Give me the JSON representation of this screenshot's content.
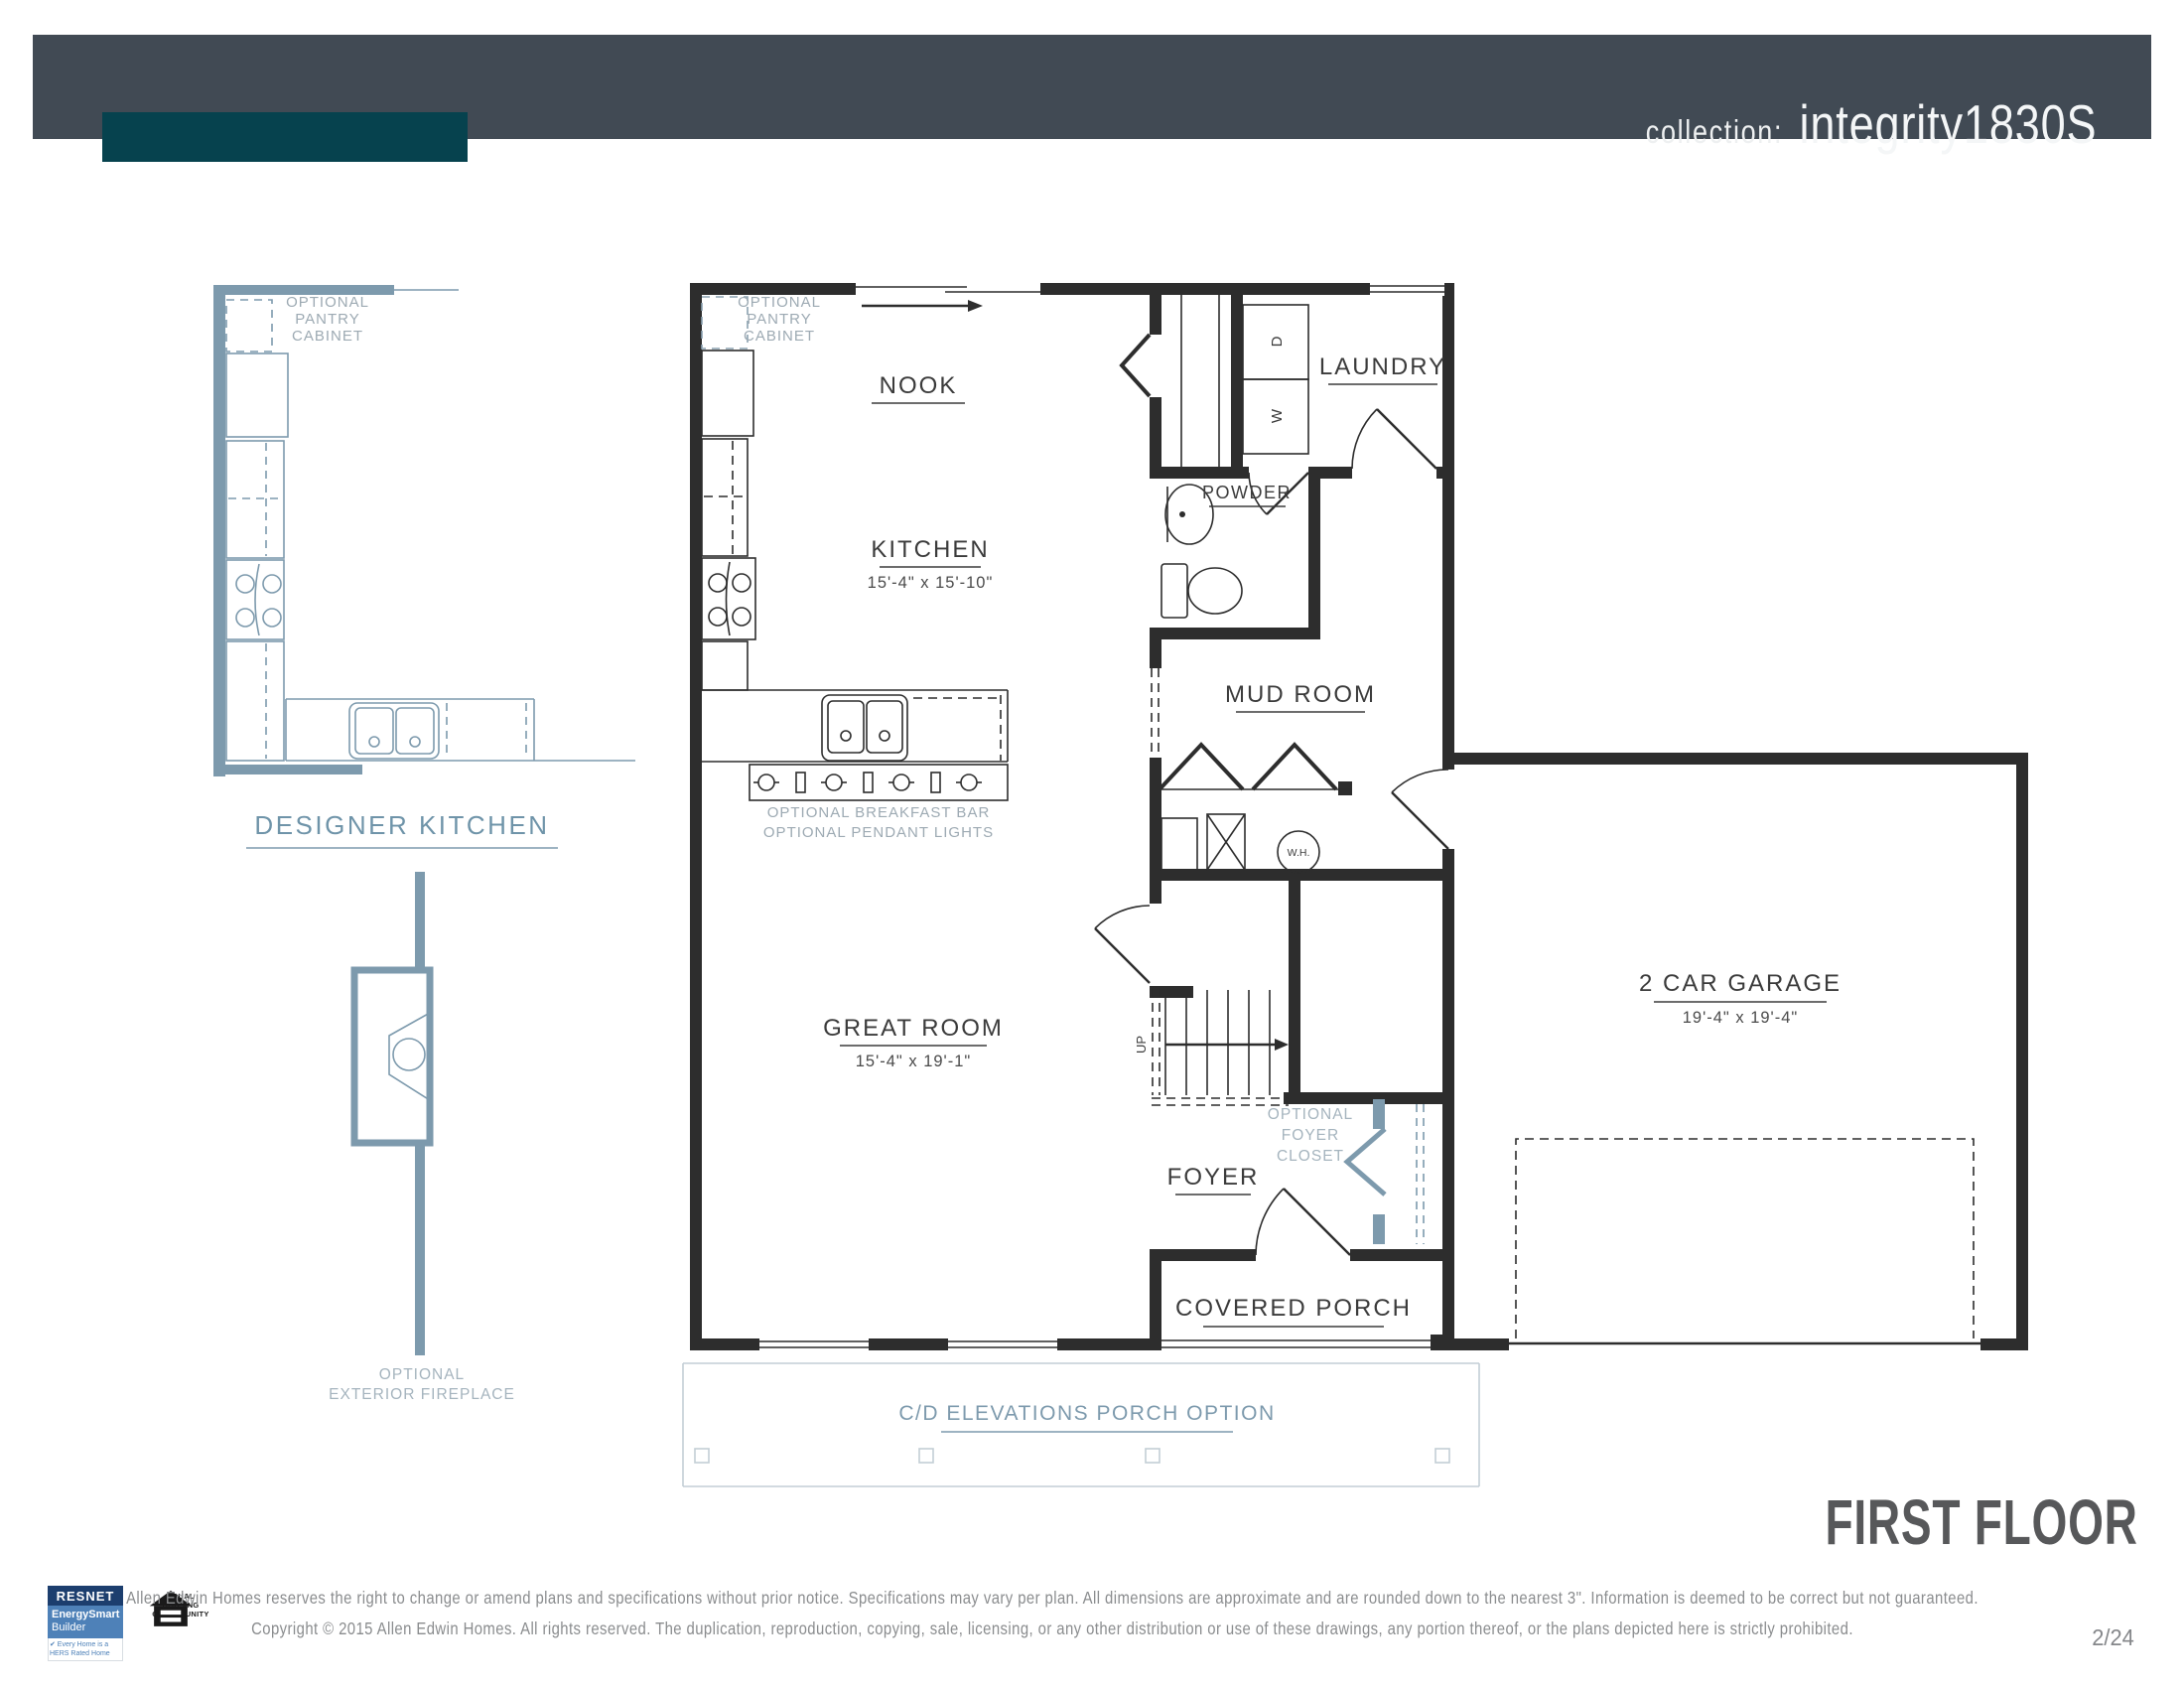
{
  "header": {
    "collection_label": "collection:",
    "model_name": "integrity1830S"
  },
  "plan": {
    "rooms": {
      "nook": {
        "label": "NOOK"
      },
      "kitchen": {
        "label": "KITCHEN",
        "dims": "15'-4\" x 15'-10\""
      },
      "laundry": {
        "label": "LAUNDRY"
      },
      "powder": {
        "label": "POWDER"
      },
      "mud_room": {
        "label": "MUD ROOM"
      },
      "great_room": {
        "label": "GREAT ROOM",
        "dims": "15'-4\" x 19'-1\""
      },
      "foyer": {
        "label": "FOYER"
      },
      "covered_porch": {
        "label": "COVERED PORCH"
      },
      "garage": {
        "label": "2 CAR GARAGE",
        "dims": "19'-4\" x 19'-4\""
      }
    },
    "appliances": {
      "dryer": "D",
      "washer": "W",
      "water_heater": "W.H.",
      "stairs_up": "UP"
    },
    "notes": {
      "pantry_line1": "OPTIONAL",
      "pantry_line2": "PANTRY",
      "pantry_line3": "CABINET",
      "breakfast_bar": "OPTIONAL BREAKFAST BAR",
      "pendant_lights": "OPTIONAL PENDANT LIGHTS",
      "foyer_closet_line1": "OPTIONAL",
      "foyer_closet_line2": "FOYER",
      "foyer_closet_line3": "CLOSET",
      "porch_option": "C/D ELEVATIONS PORCH OPTION"
    }
  },
  "side_drawings": {
    "designer_kitchen_title": "DESIGNER KITCHEN",
    "fireplace_line1": "OPTIONAL",
    "fireplace_line2": "EXTERIOR FIREPLACE"
  },
  "footer": {
    "disclaimer_line1": "Allen Edwin Homes reserves the right to change or amend plans and specifications without prior notice. Specifications may vary per plan. All dimensions are approximate and are rounded down to the nearest 3\". Information is deemed to be correct but not guaranteed.",
    "disclaimer_line2": "Copyright © 2015 Allen Edwin Homes. All rights reserved. The duplication, reproduction, copying, sale, licensing, or any other distribution or use of these drawings, any portion thereof, or the plans depicted here is strictly prohibited.",
    "page_title": "FIRST FLOOR",
    "page_number": "2/24",
    "resnet": {
      "brand": "RESNET",
      "line1": "EnergySmart",
      "line2": "Builder",
      "tagline": "✔ Every Home is a HERS Rated Home"
    },
    "equal_housing": {
      "line1": "EQUAL HOUSING",
      "line2": "OPPORTUNITY"
    }
  },
  "colors": {
    "header_bar": "#414a54",
    "header_accent": "#06424e",
    "plan_line": "#2d2d2d",
    "optional_blue": "#7d9aad",
    "note_gray": "#9daab3",
    "title_gray": "#57585a"
  }
}
